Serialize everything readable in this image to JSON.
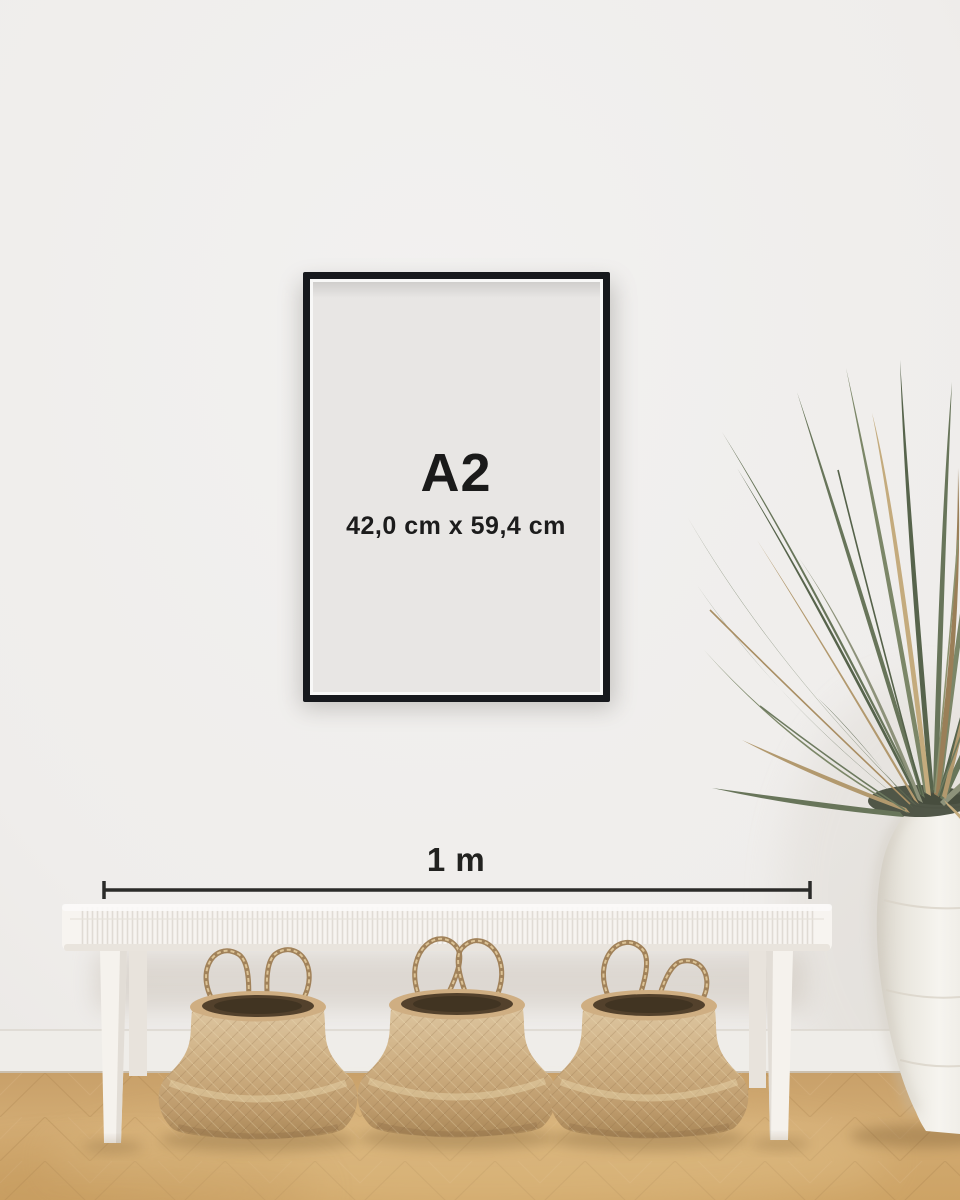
{
  "poster": {
    "size_label": "A2",
    "dimensions_label": "42,0 cm x 59,4 cm"
  },
  "scale_bar": {
    "label": "1 m"
  },
  "colors": {
    "wall": "#f0efed",
    "frame_black": "#17191d",
    "poster_paper": "#e8e6e4",
    "text_dark": "#1a1a1a",
    "scale_line": "#2b2b29",
    "floor_wood": "#cfa76f",
    "baseboard": "#efede9",
    "bench_white": "#f7f4f0",
    "basket_tan": "#c9a87c",
    "basket_opening": "#53412c",
    "vase_white": "#f2f0ea",
    "plant_green": "#66735a",
    "plant_dried": "#b2996e"
  }
}
